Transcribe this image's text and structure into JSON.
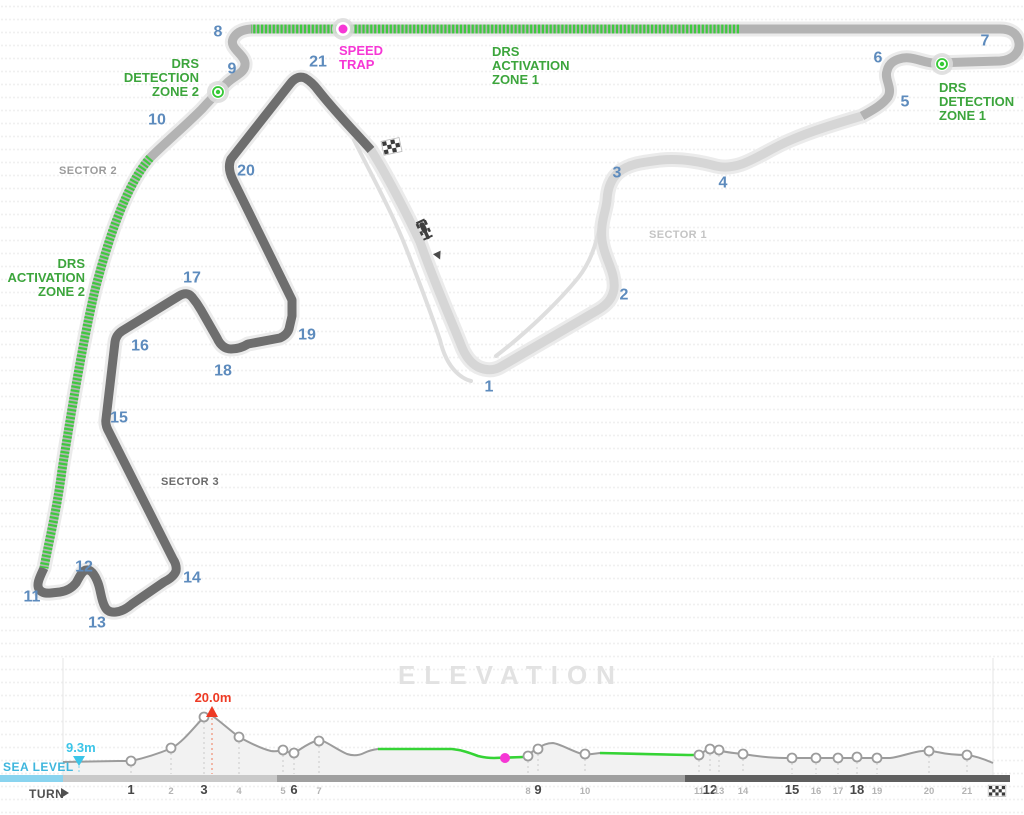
{
  "page": {
    "width": 1024,
    "height": 815,
    "background": "#ffffff"
  },
  "colors": {
    "turn_number_blue": "#5d8bbd",
    "drs_green_text": "#3ca53c",
    "drs_zone_green": "#3fc93f",
    "elevation_green": "#35d435",
    "speed_trap_magenta": "#f637d5",
    "max_red": "#ee3a24",
    "sea_cyan": "#3cc5e8",
    "sector1_track": "#d6d6d6",
    "sector2_track": "#b3b3b3",
    "sector3_track": "#6e6e6e",
    "track_halo": "#ebebeb",
    "pit_lane": "#dedede",
    "curve_gray": "#9c9c9c",
    "area_fill": "#f2f2f2",
    "bold_label": "#474747",
    "small_label": "#b4b4b4",
    "title_gray": "#e2e2e2"
  },
  "map": {
    "turn_labels": [
      {
        "n": "1",
        "x": 489,
        "y": 387
      },
      {
        "n": "2",
        "x": 624,
        "y": 295
      },
      {
        "n": "3",
        "x": 617,
        "y": 173
      },
      {
        "n": "4",
        "x": 723,
        "y": 183
      },
      {
        "n": "5",
        "x": 905,
        "y": 102
      },
      {
        "n": "6",
        "x": 878,
        "y": 58
      },
      {
        "n": "7",
        "x": 985,
        "y": 41
      },
      {
        "n": "8",
        "x": 218,
        "y": 32
      },
      {
        "n": "9",
        "x": 232,
        "y": 69
      },
      {
        "n": "10",
        "x": 157,
        "y": 120
      },
      {
        "n": "11",
        "x": 32,
        "y": 597
      },
      {
        "n": "12",
        "x": 84,
        "y": 567
      },
      {
        "n": "13",
        "x": 97,
        "y": 623
      },
      {
        "n": "14",
        "x": 192,
        "y": 578
      },
      {
        "n": "15",
        "x": 119,
        "y": 418
      },
      {
        "n": "16",
        "x": 140,
        "y": 346
      },
      {
        "n": "17",
        "x": 192,
        "y": 278
      },
      {
        "n": "18",
        "x": 223,
        "y": 371
      },
      {
        "n": "19",
        "x": 307,
        "y": 335
      },
      {
        "n": "20",
        "x": 246,
        "y": 171
      },
      {
        "n": "21",
        "x": 318,
        "y": 62
      }
    ],
    "sector_labels": [
      {
        "text": "SECTOR 1",
        "x": 678,
        "y": 235,
        "color": "#c4c4c4"
      },
      {
        "text": "SECTOR 2",
        "x": 88,
        "y": 171,
        "color": "#9b9b9b"
      },
      {
        "text": "SECTOR 3",
        "x": 190,
        "y": 482,
        "color": "#6a6a6a"
      }
    ],
    "annotations": [
      {
        "id": "drs-detection-zone-2-label",
        "lines": [
          "DRS",
          "DETECTION",
          "ZONE 2"
        ],
        "x": 199,
        "y": 68,
        "anchor": "end",
        "color": "#3ca53c"
      },
      {
        "id": "speed-trap-label",
        "lines": [
          "SPEED",
          "TRAP"
        ],
        "x": 339,
        "y": 55,
        "anchor": "start",
        "color": "#f637d5"
      },
      {
        "id": "drs-activation-zone-1-label",
        "lines": [
          "DRS",
          "ACTIVATION",
          "ZONE 1"
        ],
        "x": 492,
        "y": 56,
        "anchor": "start",
        "color": "#3ca53c"
      },
      {
        "id": "drs-detection-zone-1-label",
        "lines": [
          "DRS",
          "DETECTION",
          "ZONE 1"
        ],
        "x": 939,
        "y": 92,
        "anchor": "start",
        "color": "#3ca53c"
      },
      {
        "id": "drs-activation-zone-2-label",
        "lines": [
          "DRS",
          "ACTIVATION",
          "ZONE 2"
        ],
        "x": 85,
        "y": 268,
        "anchor": "end",
        "color": "#3ca53c"
      }
    ],
    "markers": [
      {
        "type": "drs_detection",
        "name": "drs-detection-zone-2-marker",
        "x": 218,
        "y": 92
      },
      {
        "type": "speed_trap",
        "name": "speed-trap-marker",
        "x": 343,
        "y": 29
      },
      {
        "type": "drs_detection",
        "name": "drs-detection-zone-1-marker",
        "x": 942,
        "y": 64
      }
    ]
  },
  "elevation": {
    "title": "ELEVATION",
    "sea_level_label": "SEA LEVEL",
    "axis_label": "TURN",
    "min_label": "9.3m",
    "max_label": "20.0m",
    "plot": {
      "x_left": 63,
      "x_right": 993,
      "baseline_y": 775
    },
    "sector_bar": [
      {
        "x1": 63,
        "x2": 277,
        "color": "#c9c9c9"
      },
      {
        "x1": 277,
        "x2": 685,
        "color": "#a0a0a0"
      },
      {
        "x1": 685,
        "x2": 1010,
        "color": "#5f5f5f"
      }
    ],
    "turns": [
      {
        "n": "1",
        "x": 131,
        "y": 761,
        "bold": true
      },
      {
        "n": "2",
        "x": 171,
        "y": 748,
        "bold": false
      },
      {
        "n": "3",
        "x": 204,
        "y": 717,
        "bold": true
      },
      {
        "n": "4",
        "x": 239,
        "y": 737,
        "bold": false
      },
      {
        "n": "5",
        "x": 283,
        "y": 750,
        "bold": false
      },
      {
        "n": "6",
        "x": 294,
        "y": 753,
        "bold": true
      },
      {
        "n": "7",
        "x": 319,
        "y": 741,
        "bold": false
      },
      {
        "n": "8",
        "x": 528,
        "y": 756,
        "bold": false
      },
      {
        "n": "9",
        "x": 538,
        "y": 749,
        "bold": true
      },
      {
        "n": "10",
        "x": 585,
        "y": 754,
        "bold": false
      },
      {
        "n": "11",
        "x": 699,
        "y": 755,
        "bold": false
      },
      {
        "n": "12",
        "x": 710,
        "y": 749,
        "bold": true
      },
      {
        "n": "13",
        "x": 719,
        "y": 750,
        "bold": false
      },
      {
        "n": "14",
        "x": 743,
        "y": 754,
        "bold": false
      },
      {
        "n": "15",
        "x": 792,
        "y": 758,
        "bold": true
      },
      {
        "n": "16",
        "x": 816,
        "y": 758,
        "bold": false
      },
      {
        "n": "17",
        "x": 838,
        "y": 758,
        "bold": false
      },
      {
        "n": "18",
        "x": 857,
        "y": 757,
        "bold": true
      },
      {
        "n": "19",
        "x": 877,
        "y": 758,
        "bold": false
      },
      {
        "n": "20",
        "x": 929,
        "y": 751,
        "bold": false
      },
      {
        "n": "21",
        "x": 967,
        "y": 755,
        "bold": false
      }
    ],
    "min_marker": {
      "x": 79,
      "y": 761
    },
    "max_marker": {
      "x": 212,
      "y": 716
    },
    "speed_trap_marker": {
      "x": 505,
      "y": 758
    }
  },
  "chart_data": {
    "type": "line",
    "title": "ELEVATION",
    "xlabel": "TURN",
    "x_categories": [
      "1",
      "2",
      "3",
      "4",
      "5",
      "6",
      "7",
      "8",
      "9",
      "10",
      "11",
      "12",
      "13",
      "14",
      "15",
      "16",
      "17",
      "18",
      "19",
      "20",
      "21"
    ],
    "series": [
      {
        "name": "elevation_m",
        "values": [
          9.5,
          12.6,
          20.0,
          15.1,
          12.1,
          11.4,
          14.2,
          10.7,
          12.3,
          11.2,
          10.9,
          12.3,
          12.1,
          11.2,
          10.2,
          10.2,
          10.2,
          10.5,
          10.2,
          11.9,
          10.9
        ]
      }
    ],
    "annotations": {
      "start_elevation_m": 9.3,
      "max_elevation_m": 20.0,
      "max_at_turn": 3,
      "baseline": "SEA LEVEL",
      "speed_trap_between_turns": [
        7,
        8
      ],
      "drs_zone_turn_ranges": [
        [
          7,
          8
        ],
        [
          10,
          11
        ]
      ]
    },
    "grid": false,
    "legend": false
  }
}
